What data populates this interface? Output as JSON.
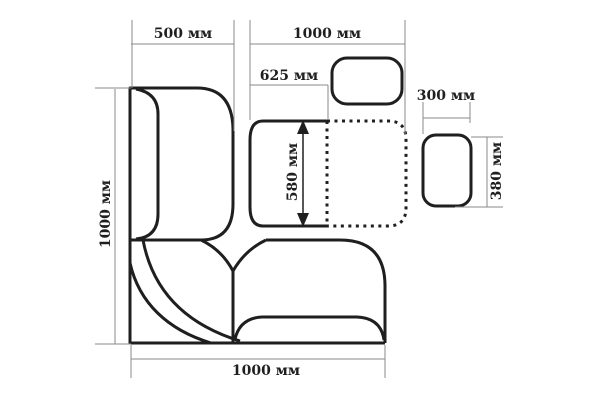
{
  "diagram": {
    "type": "furniture-dimension-plan",
    "unit": "мм",
    "labels": {
      "backrest_depth": "500 мм",
      "top_section_width": "1000 мм",
      "table_offset": "625 мм",
      "seat_depth": "580 мм",
      "stool_width": "300 мм",
      "stool_depth": "380 мм",
      "left_section_height": "1000 мм",
      "bottom_section_width": "1000 мм"
    },
    "colors": {
      "outline": "#1f1f1f",
      "dimension_line": "#8a8a8a",
      "label_text": "#1f1f1f",
      "background": "#ffffff"
    }
  }
}
